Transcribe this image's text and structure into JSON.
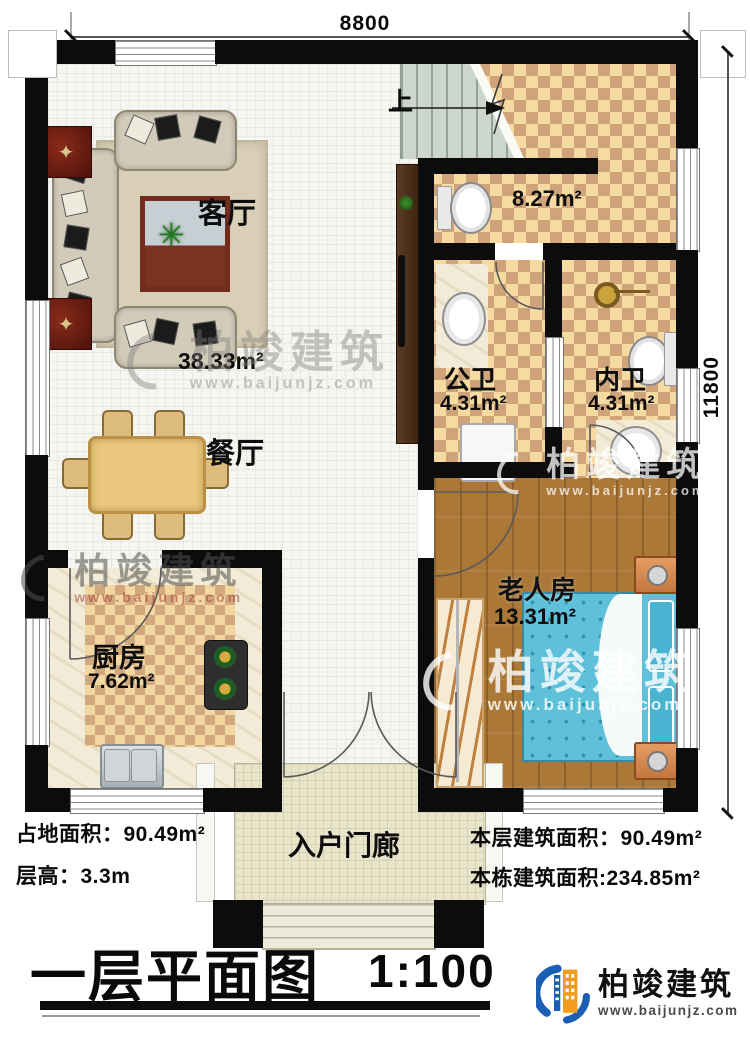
{
  "dimensions": {
    "top": "8800",
    "right": "11800"
  },
  "stairs": {
    "up_label": "上"
  },
  "rooms": {
    "living": {
      "name": "客厅",
      "area": "38.33m²"
    },
    "dining": {
      "name": "餐厅"
    },
    "kitchen": {
      "name": "厨房",
      "area": "7.62m²"
    },
    "public_bath": {
      "name": "公卫",
      "area": "4.31m²"
    },
    "inner_bath": {
      "name": "内卫",
      "area": "4.31m²"
    },
    "elder_room": {
      "name": "老人房",
      "area": "13.31m²"
    },
    "storage": {
      "area": "8.27m²"
    },
    "porch": {
      "name": "入户门廊"
    }
  },
  "info": {
    "land_area": "占地面积：90.49m²",
    "floor_height": "层高：3.3m",
    "floor_area": "本层建筑面积：90.49m²",
    "building_area": "本栋建筑面积:234.85m²"
  },
  "titleblock": {
    "title": "一层平面图",
    "scale": "1:100"
  },
  "brand": {
    "name": "柏竣建筑",
    "url": "www.baijunjz.com"
  },
  "watermark": {
    "name": "柏竣建筑",
    "url": "www.baijunjz.com"
  },
  "colors": {
    "accent_blue": "#1a5fb4",
    "accent_orange": "#f29c1f",
    "wall": "#0c0c0c"
  }
}
